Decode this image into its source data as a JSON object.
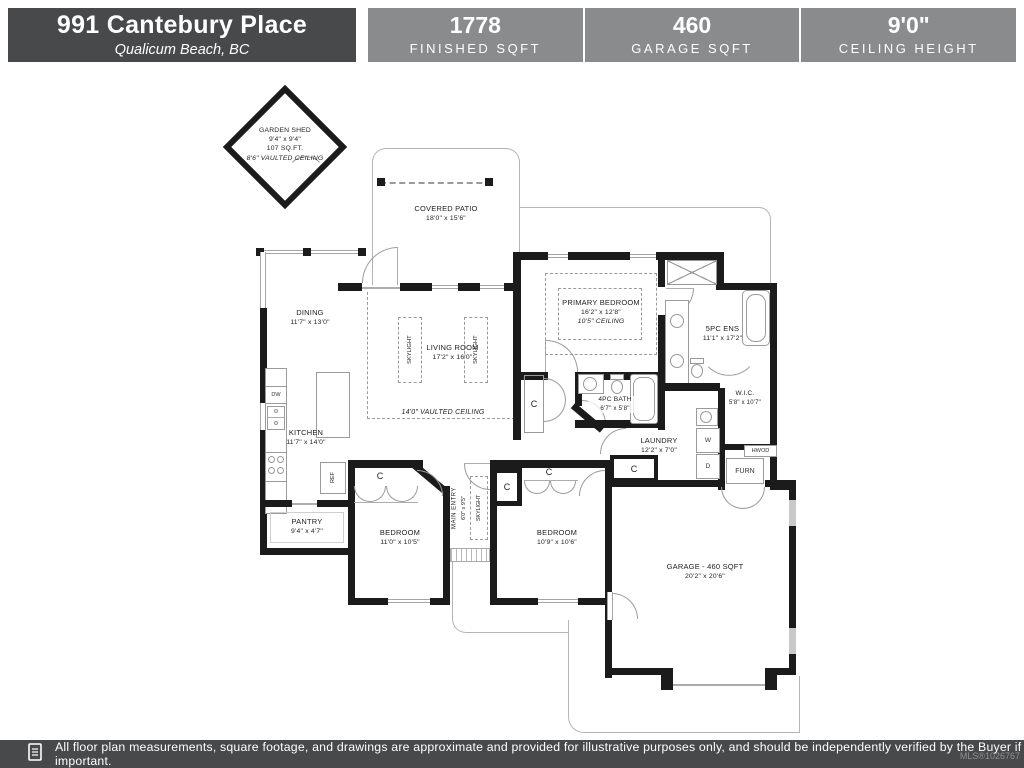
{
  "header": {
    "address_line1": "991 Cantebury Place",
    "address_line2": "Qualicum Beach, BC",
    "stats": [
      {
        "value": "1778",
        "label": "FINISHED SQFT"
      },
      {
        "value": "460",
        "label": "GARAGE SQFT"
      },
      {
        "value": "9'0\"",
        "label": "CEILING HEIGHT"
      }
    ]
  },
  "rooms": {
    "garden_shed": {
      "name": "GARDEN SHED",
      "dims": "9'4\" x 9'4\"",
      "area": "107 SQ.FT.",
      "ceiling": "8'6\" VAULTED CEILING"
    },
    "covered_patio": {
      "name": "COVERED PATIO",
      "dims": "18'0\" x 15'6\""
    },
    "dining": {
      "name": "DINING",
      "dims": "11'7\" x 13'0\""
    },
    "living": {
      "name": "LIVING ROOM",
      "dims": "17'2\" x 16'0\""
    },
    "kitchen": {
      "name": "KITCHEN",
      "dims": "11'7\" x 14'0\""
    },
    "pantry": {
      "name": "PANTRY",
      "dims": "9'4\" x 4'7\""
    },
    "bedroom1": {
      "name": "BEDROOM",
      "dims": "11'0\" x 10'5\""
    },
    "bedroom2": {
      "name": "BEDROOM",
      "dims": "10'9\" x 10'6\""
    },
    "main_entry": {
      "name": "MAIN ENTRY",
      "dims": "6'0\" x 9'5\""
    },
    "primary": {
      "name": "PRIMARY BEDROOM",
      "dims": "16'2\" x 12'8\"",
      "ceiling": "10'5\" CEILING"
    },
    "ensuite": {
      "name": "5PC ENS",
      "dims": "11'1\" x 17'2\""
    },
    "wic": {
      "name": "W.I.C.",
      "dims": "5'8\" x 10'7\""
    },
    "bath": {
      "name": "4PC BATH",
      "dims": "6'7\" x 5'8\""
    },
    "laundry": {
      "name": "LAUNDRY",
      "dims": "12'2\" x 7'0\""
    },
    "garage": {
      "name": "GARAGE - 460 SQFT",
      "dims": "20'2\" x 20'6\""
    }
  },
  "annotations": {
    "vaulted_ceiling": "14'0\" VAULTED CEILING",
    "skylight": "SKYLIGHT",
    "closet": "C",
    "washer": "W",
    "dryer": "D",
    "dishwasher": "DW",
    "fridge": "REF",
    "furnace": "FURN",
    "hot_water": "HWOD"
  },
  "footer": {
    "disclaimer": "All floor plan measurements, square footage, and drawings are approximate and provided for illustrative purposes only, and should be independently verified by the Buyer if important.",
    "mls": "MLS®1026767"
  },
  "colors": {
    "header_dark": "#48494B",
    "header_gray": "#8A8B8D",
    "wall": "#1B1B1B",
    "thin_line": "#B5B5B5"
  }
}
